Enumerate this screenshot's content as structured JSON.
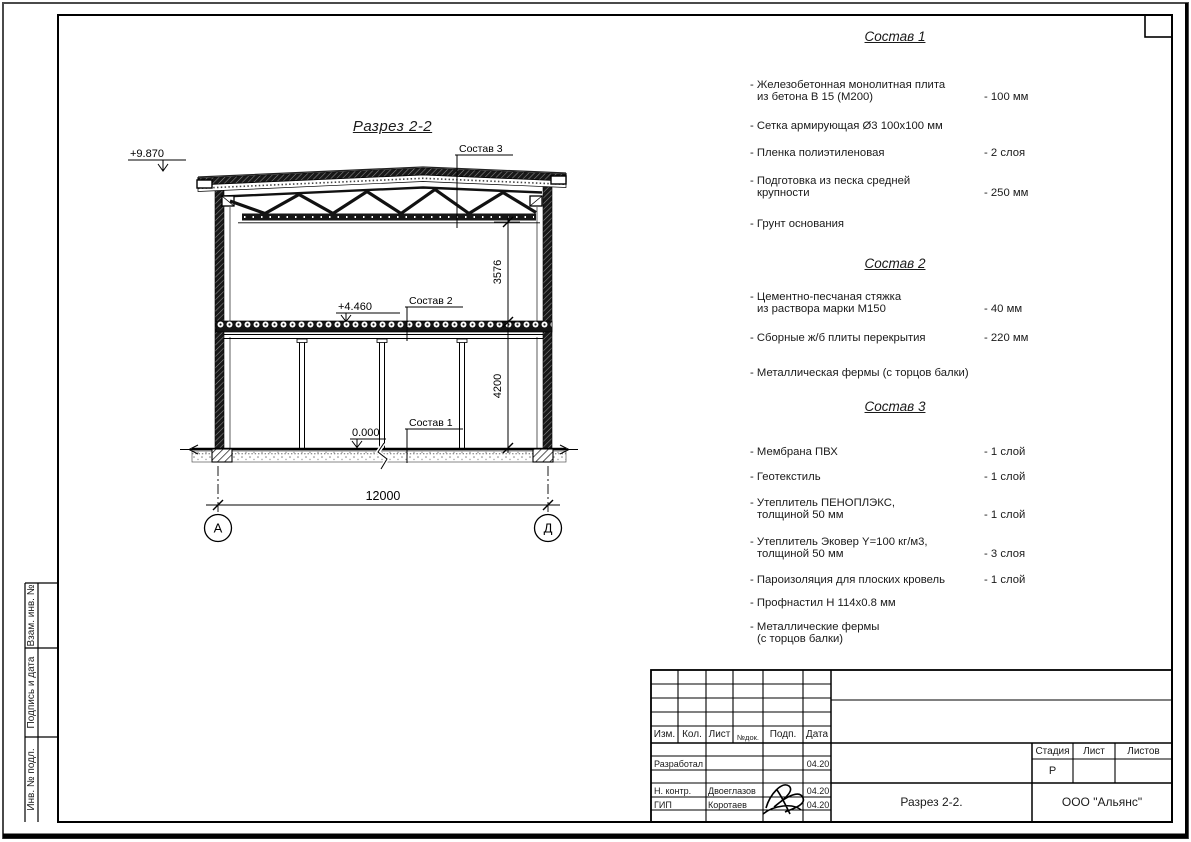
{
  "colors": {
    "ink": "#1a1a1a",
    "paper": "#ffffff"
  },
  "drawing": {
    "title": "Разрез 2-2",
    "elev_roof": "+9.870",
    "elev_floor2": "+4.460",
    "elev_zero": "0.000",
    "dim_span": "12000",
    "dim_h_upper": "3576",
    "dim_h_lower": "4200",
    "axis_left": "А",
    "axis_right": "Д",
    "callout_1": "Состав 1",
    "callout_2": "Состав 2",
    "callout_3": "Состав 3"
  },
  "compositions": [
    {
      "title": "Состав 1",
      "items": [
        {
          "line1": "- Железобетонная монолитная плита",
          "line2": "из бетона В 15 (М200)",
          "value": "- 100 мм"
        },
        {
          "line1": "- Сетка армирующая Ø3 100х100 мм",
          "line2": "",
          "value": ""
        },
        {
          "line1": "- Пленка полиэтиленовая",
          "line2": "",
          "value": "- 2 слоя"
        },
        {
          "line1": "- Подготовка из песка средней",
          "line2": "крупности",
          "value": "- 250 мм"
        },
        {
          "line1": "- Грунт основания",
          "line2": "",
          "value": ""
        }
      ]
    },
    {
      "title": "Состав 2",
      "items": [
        {
          "line1": "- Цементно-песчаная стяжка",
          "line2": "из раствора марки М150",
          "value": "- 40 мм"
        },
        {
          "line1": "- Сборные ж/б плиты перекрытия",
          "line2": "",
          "value": "- 220 мм"
        },
        {
          "line1": "- Металлическая фермы (с торцов балки)",
          "line2": "",
          "value": ""
        }
      ]
    },
    {
      "title": "Состав 3",
      "items": [
        {
          "line1": "- Мембрана ПВХ",
          "line2": "",
          "value": "- 1 слой"
        },
        {
          "line1": "- Геотекстиль",
          "line2": "",
          "value": "- 1 слой"
        },
        {
          "line1": "- Утеплитель ПЕНОПЛЭКС,",
          "line2": "толщиной 50 мм",
          "value": "- 1 слой"
        },
        {
          "line1": "- Утеплитель Эковер Y=100 кг/м3,",
          "line2": "толщиной 50 мм",
          "value": "- 3 слоя"
        },
        {
          "line1": "- Пароизоляция для плоских кровель",
          "line2": "",
          "value": "- 1 слой"
        },
        {
          "line1": "- Профнастил Н 114х0.8 мм",
          "line2": "",
          "value": ""
        },
        {
          "line1": "- Металлические фермы",
          "line2": "(с торцов балки)",
          "value": ""
        }
      ]
    }
  ],
  "side_strip": {
    "cell1": "Взам. инв. №",
    "cell2": "Подпись и дата",
    "cell3": "Инв. № подл."
  },
  "title_block": {
    "col_izm": "Изм.",
    "col_kol": "Кол.",
    "col_list": "Лист",
    "col_ndok": "№док.",
    "col_podp": "Подп.",
    "col_data": "Дата",
    "row1_role": "Разработал",
    "row1_date": "04.20",
    "row2_role": "Н. контр.",
    "row2_name": "Двоеглазов",
    "row2_date": "04.20",
    "row3_role": "ГИП",
    "row3_name": "Коротаев",
    "row3_date": "04.20",
    "stage_label": "Стадия",
    "list_label": "Лист",
    "listov_label": "Листов",
    "stage_value": "Р",
    "doc_title": "Разрез 2-2.",
    "company": "ООО \"Альянс\""
  }
}
